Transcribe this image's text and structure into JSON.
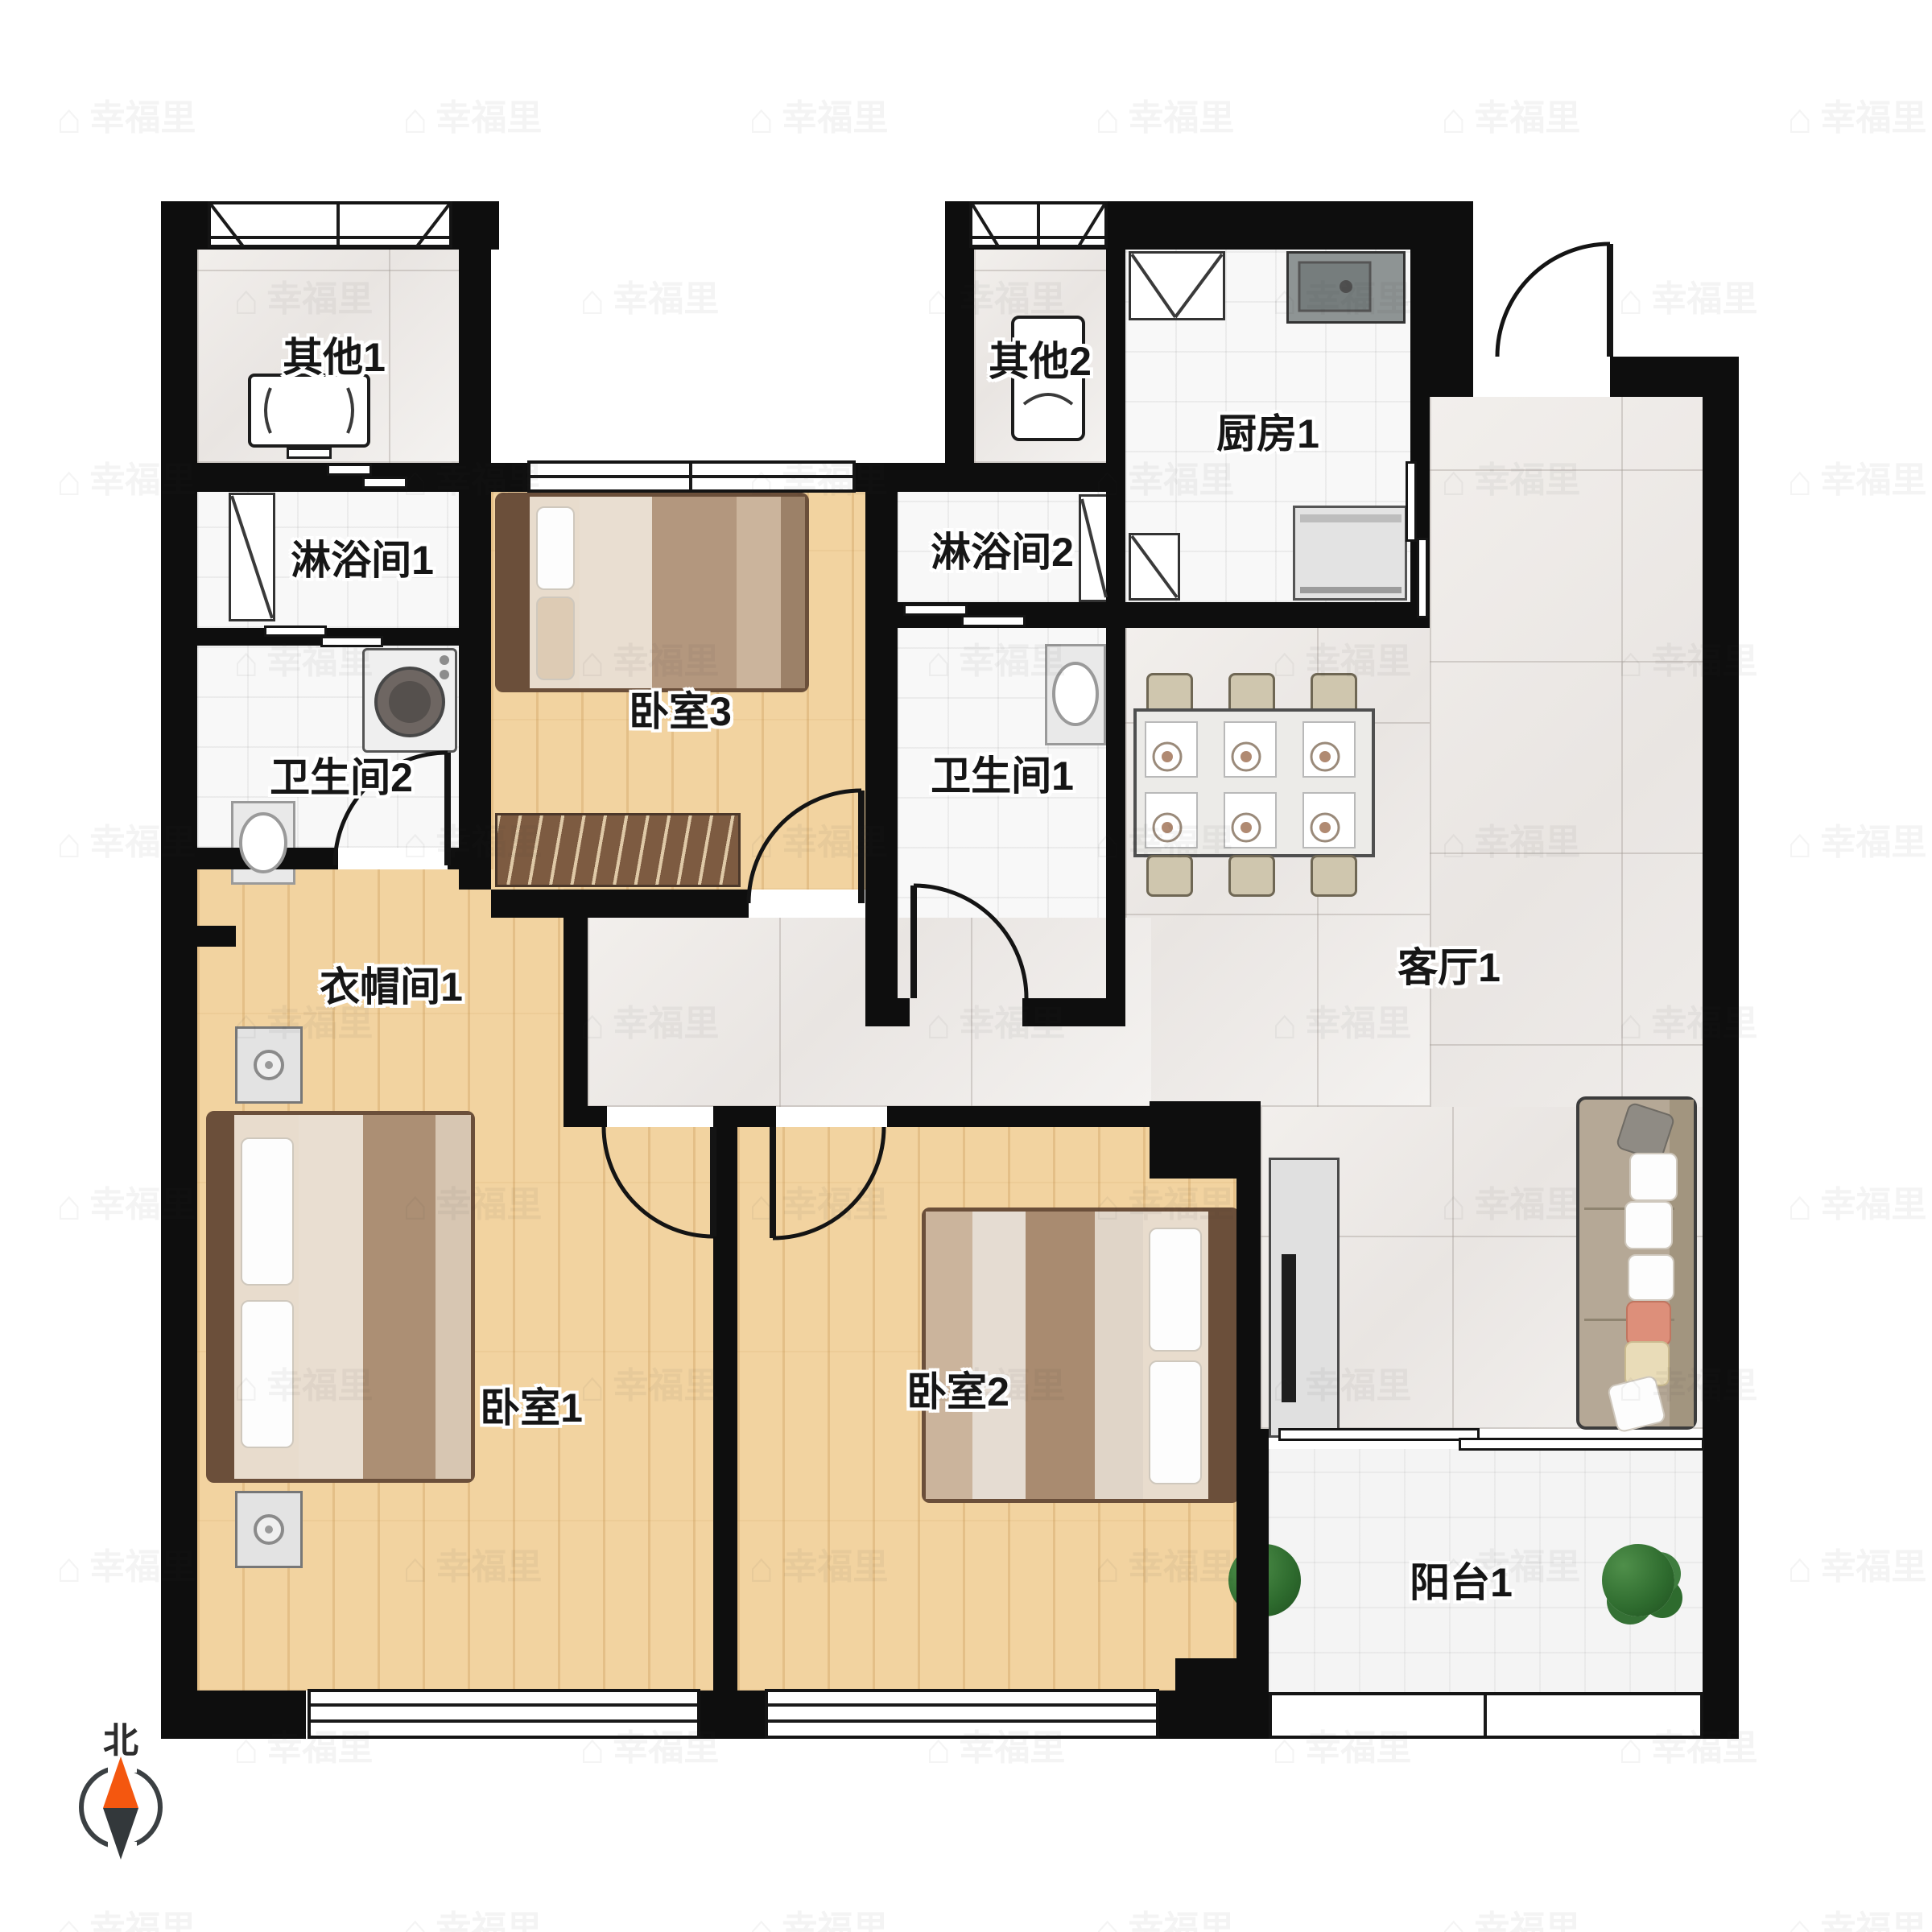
{
  "plan": {
    "title": "apartment-floor-plan",
    "rooms": {
      "other1": {
        "label": "其他1"
      },
      "shower1": {
        "label": "淋浴间1"
      },
      "bath2": {
        "label": "卫生间2"
      },
      "bedroom3": {
        "label": "卧室3"
      },
      "other2": {
        "label": "其他2"
      },
      "shower2": {
        "label": "淋浴间2"
      },
      "bath1": {
        "label": "卫生间1"
      },
      "kitchen1": {
        "label": "厨房1"
      },
      "living1": {
        "label": "客厅1"
      },
      "cloak1": {
        "label": "衣帽间1"
      },
      "bedroom1": {
        "label": "卧室1"
      },
      "bedroom2": {
        "label": "卧室2"
      },
      "balcony1": {
        "label": "阳台1"
      }
    },
    "compass": {
      "north_label": "北"
    },
    "watermark": {
      "text": "幸福里",
      "icon": "house-icon"
    },
    "colors": {
      "wall": "#0e0e0e",
      "wood_floor": "#f2d3a0",
      "marble_floor": "#efece9",
      "tile_floor": "#f8f8f8",
      "balcony_floor": "#f4f4f4",
      "compass_north": "#f4570f",
      "compass_south": "#33383b",
      "bench": "#7d5b41",
      "sofa": "#b5a896"
    },
    "furniture_icons": [
      "bed-icon",
      "bench-icon",
      "washing-machine-icon",
      "sink-icon",
      "shower-icon",
      "dining-table-icon",
      "chair-icon",
      "sofa-icon",
      "tv-stand-icon",
      "plant-icon",
      "stove-icon",
      "kitchen-sink-icon",
      "nightstand-icon",
      "table-icon"
    ]
  }
}
